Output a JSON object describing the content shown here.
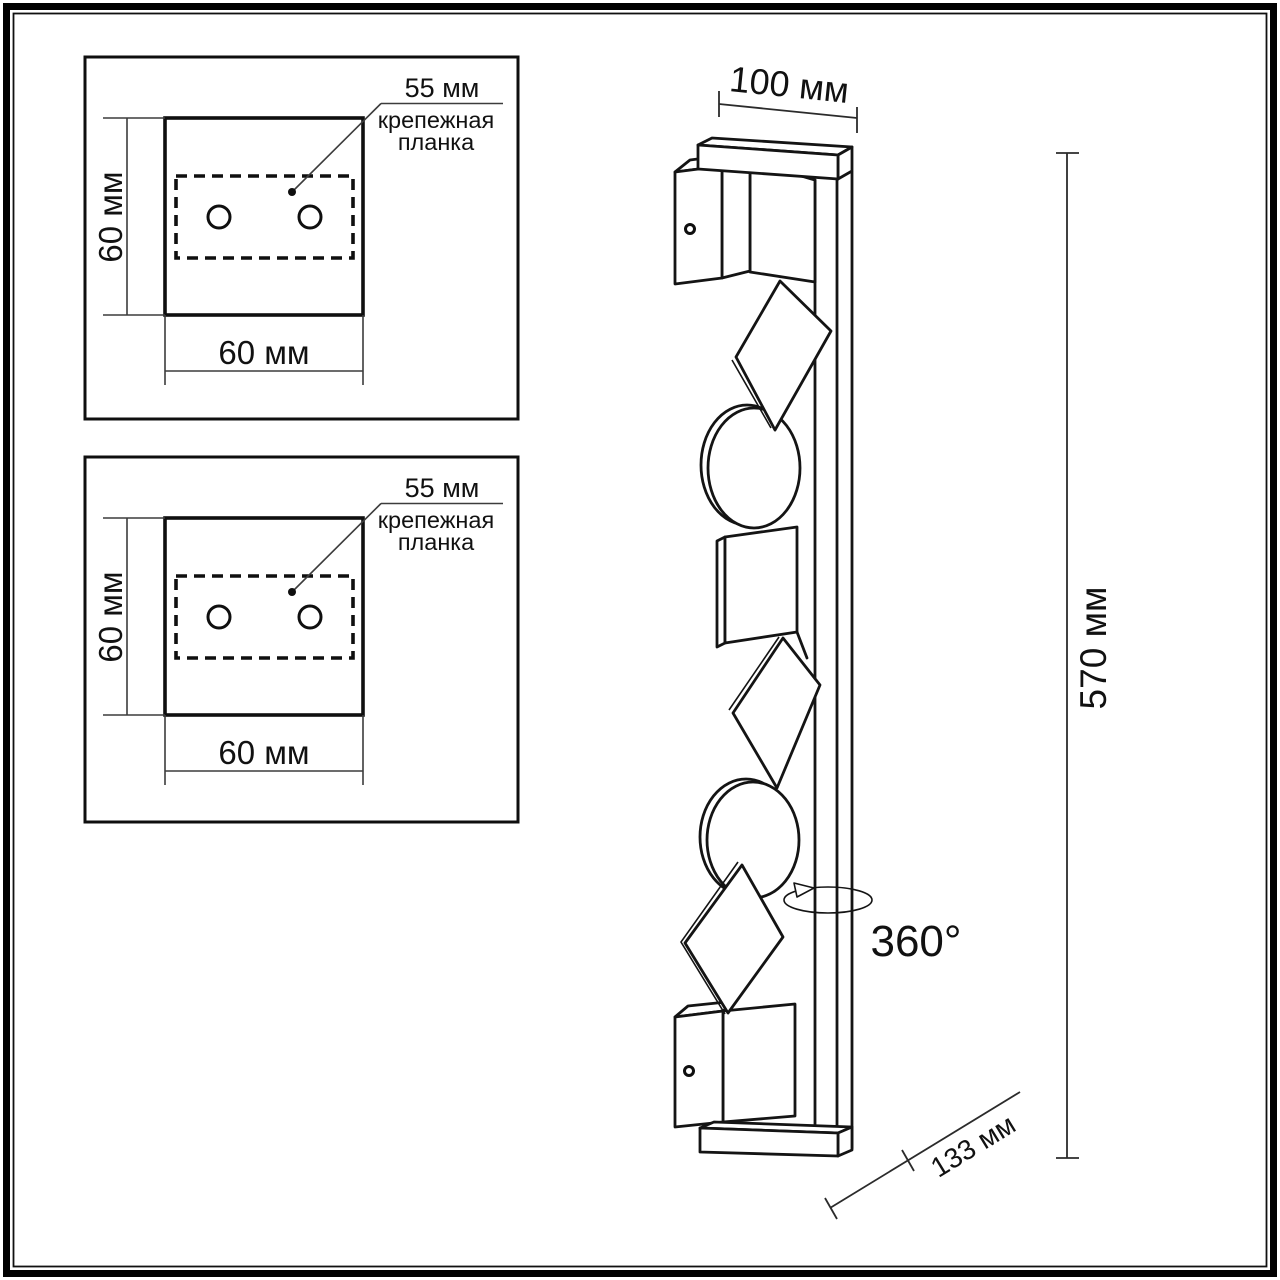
{
  "drawing_type": "wall-light installation dimensions",
  "panels": [
    {
      "id": "top",
      "square_width": "60 мм",
      "square_height": "60 мм",
      "plate_width": "55 мм",
      "plate_caption_line1": "крепежная",
      "plate_caption_line2": "планка",
      "screw_holes": 2
    },
    {
      "id": "bottom",
      "square_width": "60 мм",
      "square_height": "60 мм",
      "plate_width": "55 мм",
      "plate_caption_line1": "крепежная",
      "plate_caption_line2": "планка",
      "screw_holes": 2
    }
  ],
  "side_view": {
    "top_width": "100 мм",
    "height": "570 мм",
    "depth": "133 мм",
    "rotation": "360°"
  },
  "style": {
    "ink": "#111111",
    "thin_line": "#3c3c3c",
    "background": "#ffffff"
  }
}
